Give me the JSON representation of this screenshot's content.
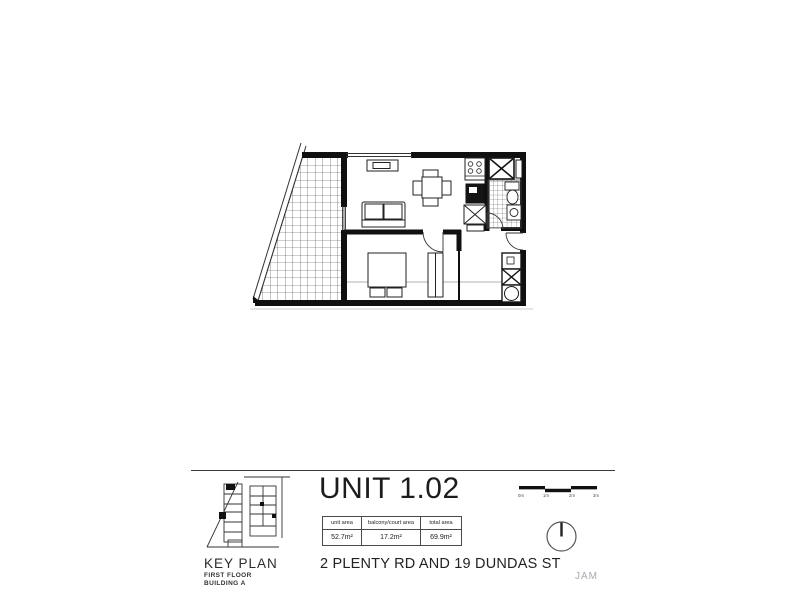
{
  "title_block": {
    "unit_title": "UNIT 1.02",
    "address": "2 PLENTY RD AND 19 DUNDAS ST",
    "watermark": "JAM",
    "key_plan": {
      "title": "KEY PLAN",
      "line1": "FIRST FLOOR",
      "line2": "BUILDING A"
    },
    "areas_table": {
      "headers": [
        "unit area",
        "balcony/court area",
        "total area"
      ],
      "values": [
        "52.7m²",
        "17.2m²",
        "69.9m²"
      ]
    },
    "scale_bar": {
      "labels": [
        "0m",
        "1m",
        "2m",
        "3m"
      ]
    }
  },
  "colors": {
    "paper": "#ffffff",
    "line": "#1a1a1a",
    "muted_text": "#a9a9b2"
  }
}
